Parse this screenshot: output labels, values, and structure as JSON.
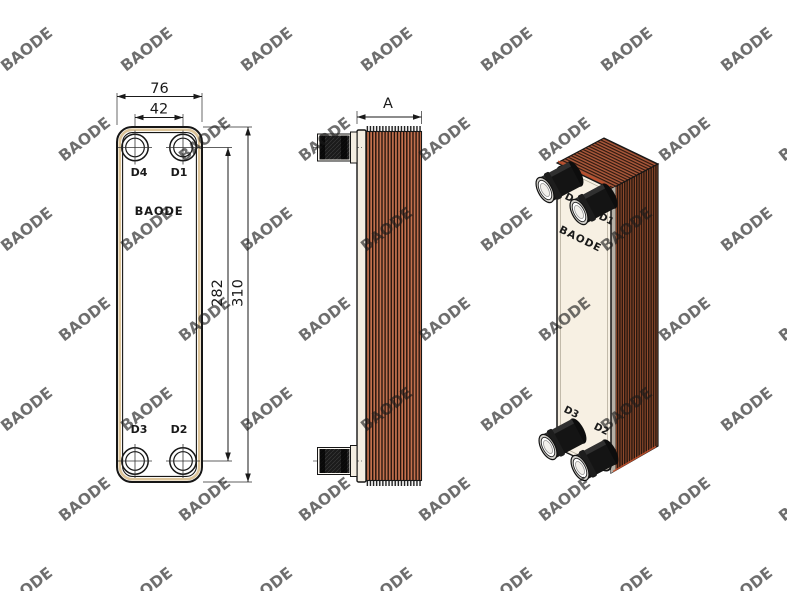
{
  "watermark": {
    "text": "BAODE"
  },
  "front_view": {
    "brand_label": "BAODE",
    "dimensions": {
      "overall_width": "76",
      "port_width_spacing": "42",
      "port_height_spacing": "282",
      "overall_height": "310"
    },
    "ports": {
      "top_left": "D4",
      "top_right": "D1",
      "bottom_left": "D3",
      "bottom_right": "D2"
    }
  },
  "side_view": {
    "dimensions": {
      "depth": "A"
    }
  },
  "iso_view": {
    "brand_label": "BAODE",
    "ports": {
      "top_left": "D4",
      "top_right": "D1",
      "bottom_left": "D3",
      "bottom_right": "D2"
    }
  },
  "colors": {
    "line": "#1a1a1a",
    "plate_cream": "#f7f0e3",
    "edge_plate_white": "#f4eee2",
    "gasket_tan": "#dcc49a",
    "copper": "#c4714e",
    "stripe_dark": "#24140d",
    "iso_side_dark": "#2a1810",
    "iso_side_copper": "#9a4f2e",
    "iso_top_copper": "#a8573a",
    "iso_top_dark": "#2d180e",
    "accent_orange": "#c5502c",
    "port_black": "#1b1b1b",
    "watermark_gray": "#d4d4d4"
  }
}
